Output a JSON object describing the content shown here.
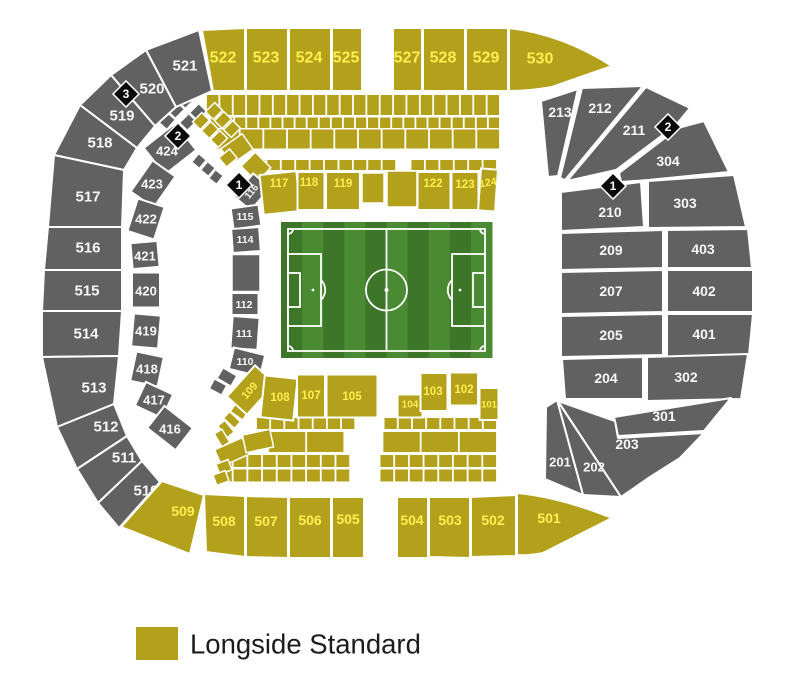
{
  "palette": {
    "longside_standard": "#b3a11b",
    "unavailable": "#616161",
    "label_on_yellow": "#ffee4f",
    "label_on_gray": "#f7f7f7",
    "marker_bg": "#0b0b0b",
    "marker_text": "#ffffff",
    "pitch_dark": "#3e7629",
    "pitch_light": "#4a8a33",
    "pitch_line": "#ffffff",
    "legend_text_color": "#1c1c1c"
  },
  "legend": {
    "items": [
      {
        "label": "Longside Standard",
        "swatch_color": "#b3a11b"
      }
    ]
  },
  "map": {
    "markers": [
      {
        "id": "marker-nw-3",
        "label": "3"
      },
      {
        "id": "marker-nw-2",
        "label": "2"
      },
      {
        "id": "marker-nw-1",
        "label": "1"
      },
      {
        "id": "marker-ne-2",
        "label": "2"
      },
      {
        "id": "marker-ne-1",
        "label": "1"
      }
    ],
    "sections": [
      {
        "id": "521",
        "label": "521",
        "category": "unavailable"
      },
      {
        "id": "520",
        "label": "520",
        "category": "unavailable"
      },
      {
        "id": "519",
        "label": "519",
        "category": "unavailable"
      },
      {
        "id": "518",
        "label": "518",
        "category": "unavailable"
      },
      {
        "id": "517",
        "label": "517",
        "category": "unavailable"
      },
      {
        "id": "516",
        "label": "516",
        "category": "unavailable"
      },
      {
        "id": "515",
        "label": "515",
        "category": "unavailable"
      },
      {
        "id": "514",
        "label": "514",
        "category": "unavailable"
      },
      {
        "id": "513",
        "label": "513",
        "category": "unavailable"
      },
      {
        "id": "512",
        "label": "512",
        "category": "unavailable"
      },
      {
        "id": "511",
        "label": "511",
        "category": "unavailable"
      },
      {
        "id": "510",
        "label": "510",
        "category": "unavailable"
      },
      {
        "id": "509",
        "label": "509",
        "category": "longside-standard"
      },
      {
        "id": "508",
        "label": "508",
        "category": "longside-standard"
      },
      {
        "id": "507",
        "label": "507",
        "category": "longside-standard"
      },
      {
        "id": "506",
        "label": "506",
        "category": "longside-standard"
      },
      {
        "id": "505",
        "label": "505",
        "category": "longside-standard"
      },
      {
        "id": "504",
        "label": "504",
        "category": "longside-standard"
      },
      {
        "id": "503",
        "label": "503",
        "category": "longside-standard"
      },
      {
        "id": "502",
        "label": "502",
        "category": "longside-standard"
      },
      {
        "id": "501",
        "label": "501",
        "category": "longside-standard"
      },
      {
        "id": "522",
        "label": "522",
        "category": "longside-standard"
      },
      {
        "id": "523",
        "label": "523",
        "category": "longside-standard"
      },
      {
        "id": "524",
        "label": "524",
        "category": "longside-standard"
      },
      {
        "id": "525",
        "label": "525",
        "category": "longside-standard"
      },
      {
        "id": "527",
        "label": "527",
        "category": "longside-standard"
      },
      {
        "id": "528",
        "label": "528",
        "category": "longside-standard"
      },
      {
        "id": "529",
        "label": "529",
        "category": "longside-standard"
      },
      {
        "id": "530",
        "label": "530",
        "category": "longside-standard"
      },
      {
        "id": "424",
        "label": "424",
        "category": "unavailable"
      },
      {
        "id": "423",
        "label": "423",
        "category": "unavailable"
      },
      {
        "id": "422",
        "label": "422",
        "category": "unavailable"
      },
      {
        "id": "421",
        "label": "421",
        "category": "unavailable"
      },
      {
        "id": "420",
        "label": "420",
        "category": "unavailable"
      },
      {
        "id": "419",
        "label": "419",
        "category": "unavailable"
      },
      {
        "id": "418",
        "label": "418",
        "category": "unavailable"
      },
      {
        "id": "417",
        "label": "417",
        "category": "unavailable"
      },
      {
        "id": "416",
        "label": "416",
        "category": "unavailable"
      },
      {
        "id": "116",
        "label": "116",
        "category": "unavailable"
      },
      {
        "id": "115",
        "label": "115",
        "category": "unavailable"
      },
      {
        "id": "114",
        "label": "114",
        "category": "unavailable"
      },
      {
        "id": "112",
        "label": "112",
        "category": "unavailable"
      },
      {
        "id": "111",
        "label": "111",
        "category": "unavailable"
      },
      {
        "id": "110",
        "label": "110",
        "category": "unavailable"
      },
      {
        "id": "117",
        "label": "117",
        "category": "longside-standard"
      },
      {
        "id": "118",
        "label": "118",
        "category": "longside-standard"
      },
      {
        "id": "119",
        "label": "119",
        "category": "longside-standard"
      },
      {
        "id": "122",
        "label": "122",
        "category": "longside-standard"
      },
      {
        "id": "123",
        "label": "123",
        "category": "longside-standard"
      },
      {
        "id": "124",
        "label": "124",
        "category": "longside-standard"
      },
      {
        "id": "109",
        "label": "109",
        "category": "longside-standard"
      },
      {
        "id": "108",
        "label": "108",
        "category": "longside-standard"
      },
      {
        "id": "107",
        "label": "107",
        "category": "longside-standard"
      },
      {
        "id": "105",
        "label": "105",
        "category": "longside-standard"
      },
      {
        "id": "104",
        "label": "104",
        "category": "longside-standard"
      },
      {
        "id": "103",
        "label": "103",
        "category": "longside-standard"
      },
      {
        "id": "102",
        "label": "102",
        "category": "longside-standard"
      },
      {
        "id": "101",
        "label": "101",
        "category": "longside-standard"
      },
      {
        "id": "213",
        "label": "213",
        "category": "unavailable"
      },
      {
        "id": "212",
        "label": "212",
        "category": "unavailable"
      },
      {
        "id": "211",
        "label": "211",
        "category": "unavailable"
      },
      {
        "id": "304",
        "label": "304",
        "category": "unavailable"
      },
      {
        "id": "210",
        "label": "210",
        "category": "unavailable"
      },
      {
        "id": "303",
        "label": "303",
        "category": "unavailable"
      },
      {
        "id": "209",
        "label": "209",
        "category": "unavailable"
      },
      {
        "id": "403",
        "label": "403",
        "category": "unavailable"
      },
      {
        "id": "207",
        "label": "207",
        "category": "unavailable"
      },
      {
        "id": "402",
        "label": "402",
        "category": "unavailable"
      },
      {
        "id": "205",
        "label": "205",
        "category": "unavailable"
      },
      {
        "id": "401",
        "label": "401",
        "category": "unavailable"
      },
      {
        "id": "204",
        "label": "204",
        "category": "unavailable"
      },
      {
        "id": "302",
        "label": "302",
        "category": "unavailable"
      },
      {
        "id": "301",
        "label": "301",
        "category": "unavailable"
      },
      {
        "id": "203",
        "label": "203",
        "category": "unavailable"
      },
      {
        "id": "202",
        "label": "202",
        "category": "unavailable"
      },
      {
        "id": "201",
        "label": "201",
        "category": "unavailable"
      }
    ]
  }
}
